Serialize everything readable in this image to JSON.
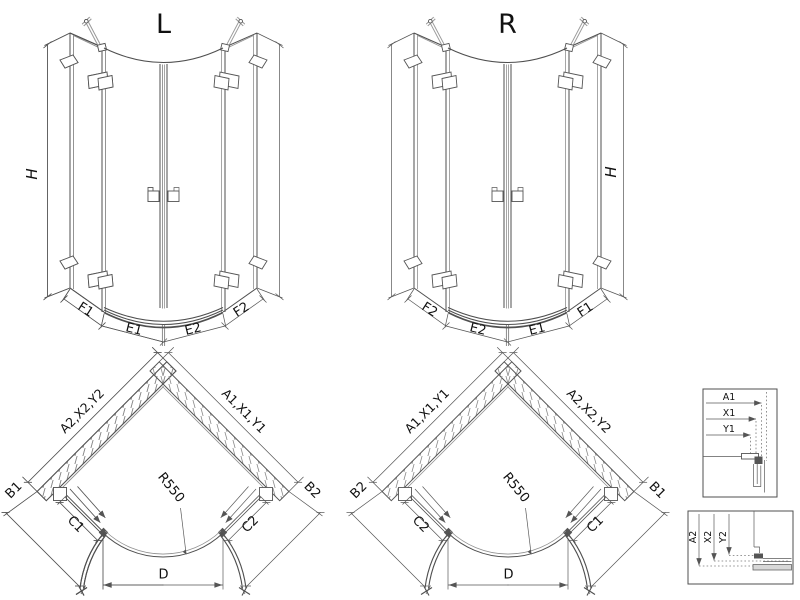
{
  "drawing_type": "shower-enclosure-technical-drawing",
  "colors": {
    "background": "#ffffff",
    "line": "#4f4f4f",
    "light_line": "#909090",
    "text": "#111111"
  },
  "elevation_left": {
    "title": "L",
    "height_label": "H",
    "segment_labels": [
      "F1",
      "E1",
      "E2",
      "F2"
    ]
  },
  "elevation_right": {
    "title": "R",
    "height_label": "H",
    "segment_labels": [
      "F2",
      "E2",
      "E1",
      "F1"
    ]
  },
  "plan_left": {
    "left_wall": "A2,X2,Y2",
    "right_wall": "A1,X1,Y1",
    "outer_left": "B1",
    "outer_right": "B2",
    "inner_left": "C1",
    "inner_right": "C2",
    "radius": "R550",
    "door_span": "D"
  },
  "plan_right": {
    "left_wall": "A1,X1,Y1",
    "right_wall": "A2,X2,Y2",
    "outer_left": "B2",
    "outer_right": "B1",
    "inner_left": "C2",
    "inner_right": "C1",
    "radius": "R550",
    "door_span": "D"
  },
  "detail_top": {
    "dims": [
      "A1",
      "X1",
      "Y1"
    ]
  },
  "detail_bottom": {
    "dims": [
      "A2",
      "X2",
      "Y2"
    ]
  }
}
